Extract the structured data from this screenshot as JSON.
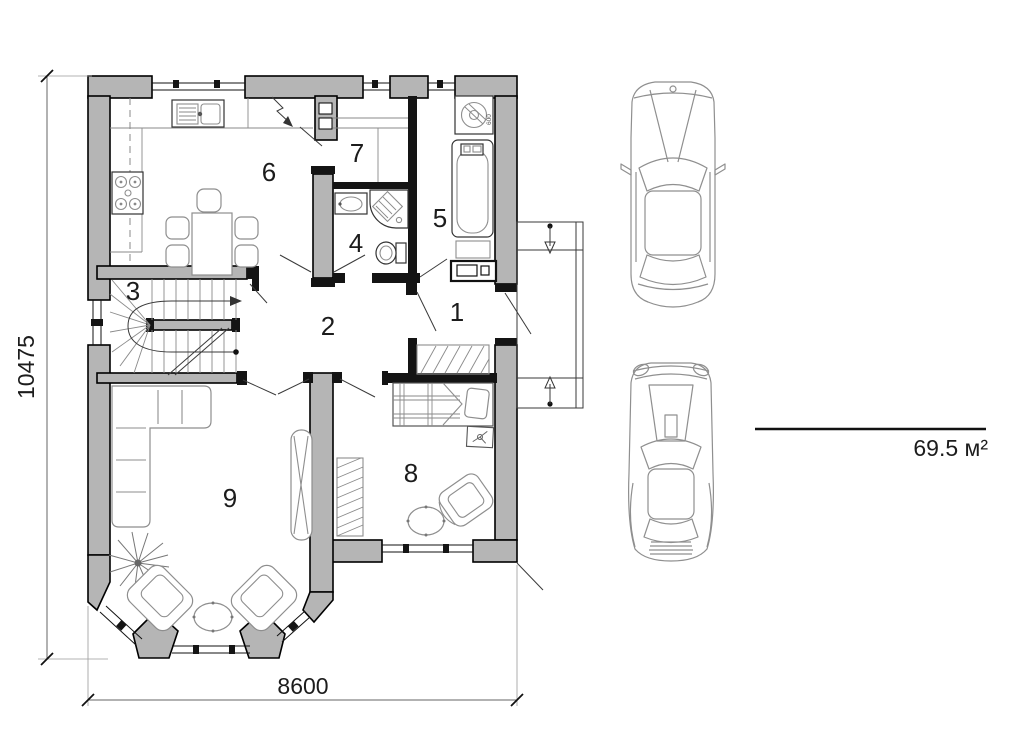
{
  "plan": {
    "rooms": [
      {
        "number": "1"
      },
      {
        "number": "2"
      },
      {
        "number": "3"
      },
      {
        "number": "4"
      },
      {
        "number": "5"
      },
      {
        "number": "6"
      },
      {
        "number": "7"
      },
      {
        "number": "8"
      },
      {
        "number": "9"
      }
    ],
    "dimensions": {
      "vertical_mm": "10475",
      "horizontal_mm": "8600"
    },
    "area_label": "69.5 м²",
    "appliance_width_label": "600",
    "vehicles": [
      {
        "icon": "sedan-top-view-icon"
      },
      {
        "icon": "sports-car-top-view-icon"
      }
    ],
    "colors": {
      "wall_fill": "#b5b5b5",
      "outline": "#000000",
      "furniture_line": "#8e8e8e",
      "dimension_line": "#666666"
    }
  }
}
